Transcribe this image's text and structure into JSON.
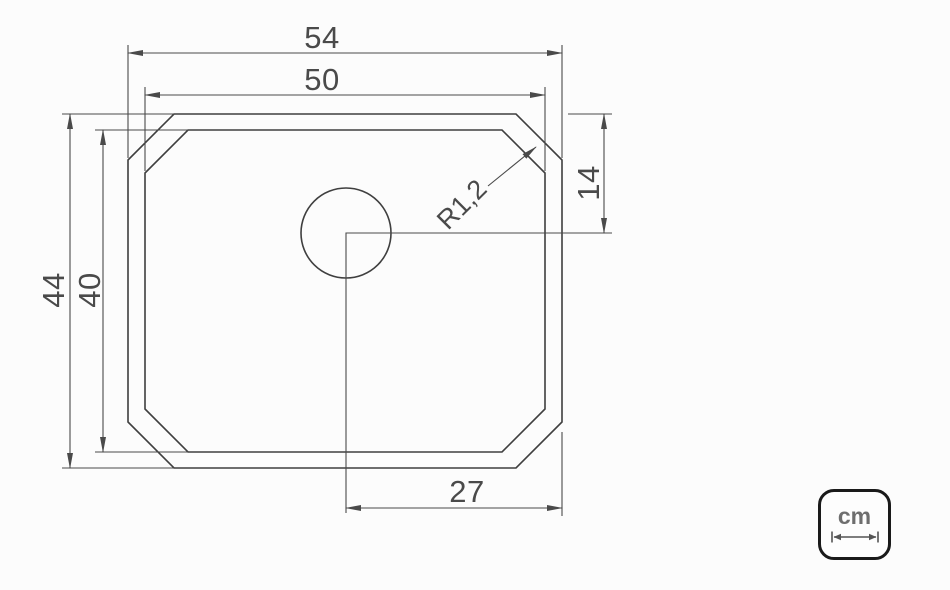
{
  "page": {
    "background": "#fcfcfc"
  },
  "colors": {
    "outline": "#3f3f3f",
    "dimension_lines": "#4a4a4a",
    "dimension_text": "#4a4a4a",
    "badge_border": "#1a1a1a",
    "badge_text": "#6e6e6e"
  },
  "drawing": {
    "type": "sink-top-view-dimensioned-drawing",
    "dimensions": {
      "outer_width": "54",
      "inner_width": "50",
      "outer_height": "44",
      "inner_height": "40",
      "drain_center_from_top": "14",
      "drain_center_from_right_edge": "27",
      "corner_radius": "R1,2"
    },
    "unit_badge": {
      "label": "cm"
    }
  }
}
